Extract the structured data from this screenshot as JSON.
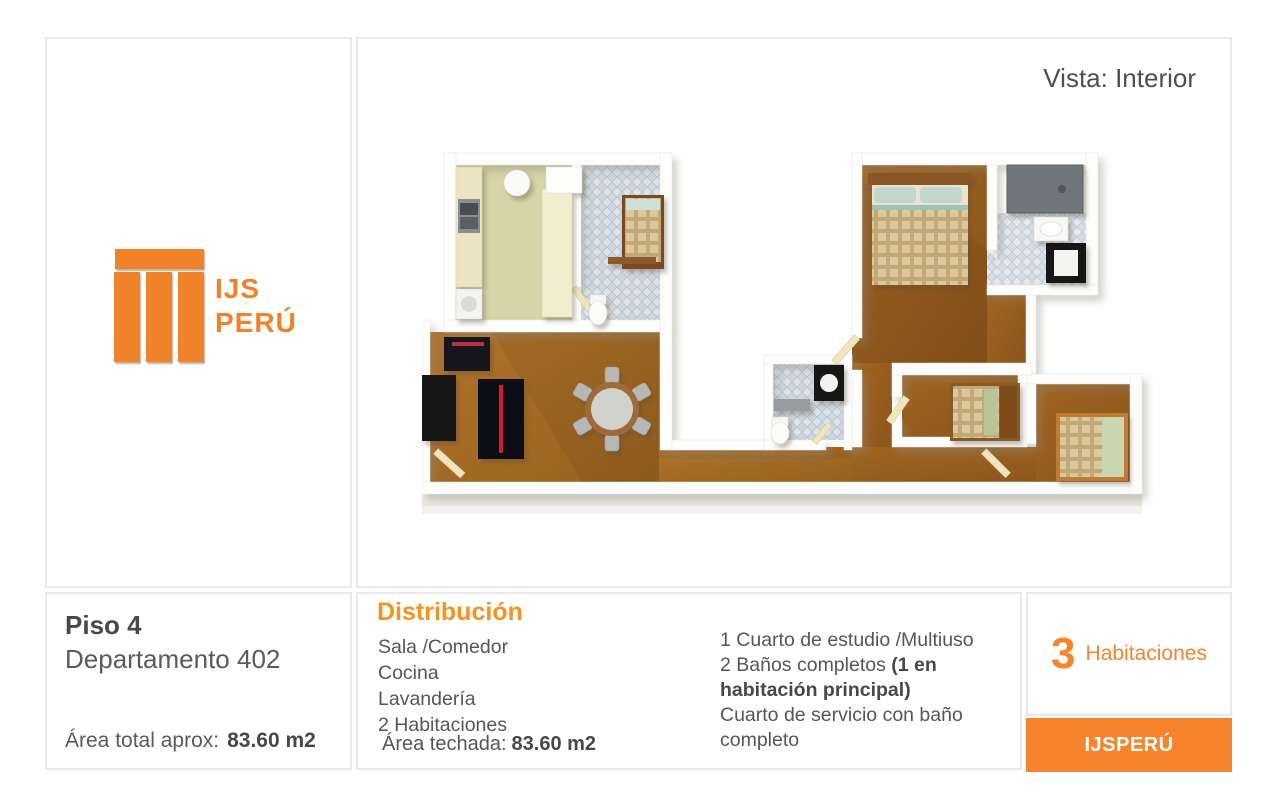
{
  "colors": {
    "brand_orange": "#f0822a",
    "heading_orange": "#f7921e",
    "button_orange": "#f5842c",
    "text_dark": "#48484b",
    "text_gray": "#55565a",
    "panel_border": "#e9e9e9",
    "floor_wood": "#a86d27",
    "floor_tile_blue": "#cfd7df",
    "floor_kitchen_green": "#d6d4a8"
  },
  "logo": {
    "line1": "IJS",
    "line2": "PERÚ"
  },
  "view": {
    "label": "Vista: Interior"
  },
  "unit": {
    "floor": "Piso 4",
    "apartment": "Departamento 402",
    "area_total_label": "Área total aprox:",
    "area_total_value": "83.60 m2"
  },
  "distribution": {
    "title": "Distribución",
    "column1": [
      "Sala /Comedor",
      "Cocina",
      "Lavandería",
      "2 Habitaciones"
    ],
    "area_roofed_label": "Área techada:",
    "area_roofed_value": "83.60 m2",
    "column2_line1": "1 Cuarto de estudio /Multiuso",
    "column2_line2_normal": "2 Baños completos ",
    "column2_line2_bold": "(1 en habitación principal)",
    "column2_line3": "Cuarto de servicio con baño completo"
  },
  "rooms_badge": {
    "count": "3",
    "label": "Habitaciones"
  },
  "footer": {
    "button_label": "IJSPERÚ"
  }
}
